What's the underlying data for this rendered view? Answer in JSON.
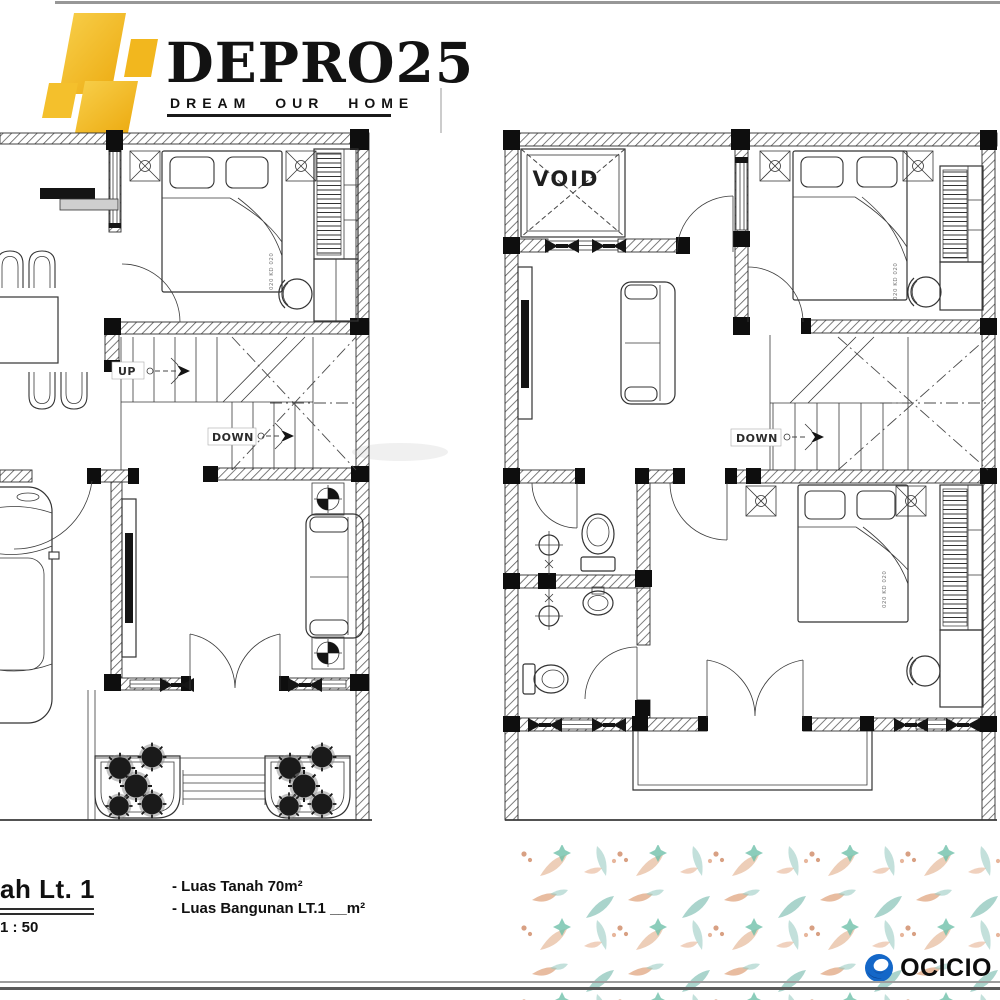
{
  "logo": {
    "brand": "DEPRO25",
    "tagline": "DREAM OUR HOME"
  },
  "plans": {
    "left": {
      "up_label": "UP",
      "down_label": "DOWN",
      "bed_dim": "020 KD 020"
    },
    "right": {
      "void_label": "VOID",
      "down_label": "DOWN",
      "bed_dim_top": "020 KD 020",
      "bed_dim_bottom": "020 KD 020"
    }
  },
  "caption": {
    "title": "ah Lt. 1",
    "scale": "1 : 50",
    "notes": [
      "- Luas Tanah 70m²",
      "- Luas Bangunan LT.1 __m²"
    ]
  },
  "brand_footer": {
    "name": "OCICIO"
  },
  "colors": {
    "gold": "#f2b71e",
    "ink": "#2f2f2f",
    "ocicio_blue": "#1467c8",
    "leaf_teal": "#8fc7bc",
    "leaf_salmon": "#dfa27c"
  }
}
